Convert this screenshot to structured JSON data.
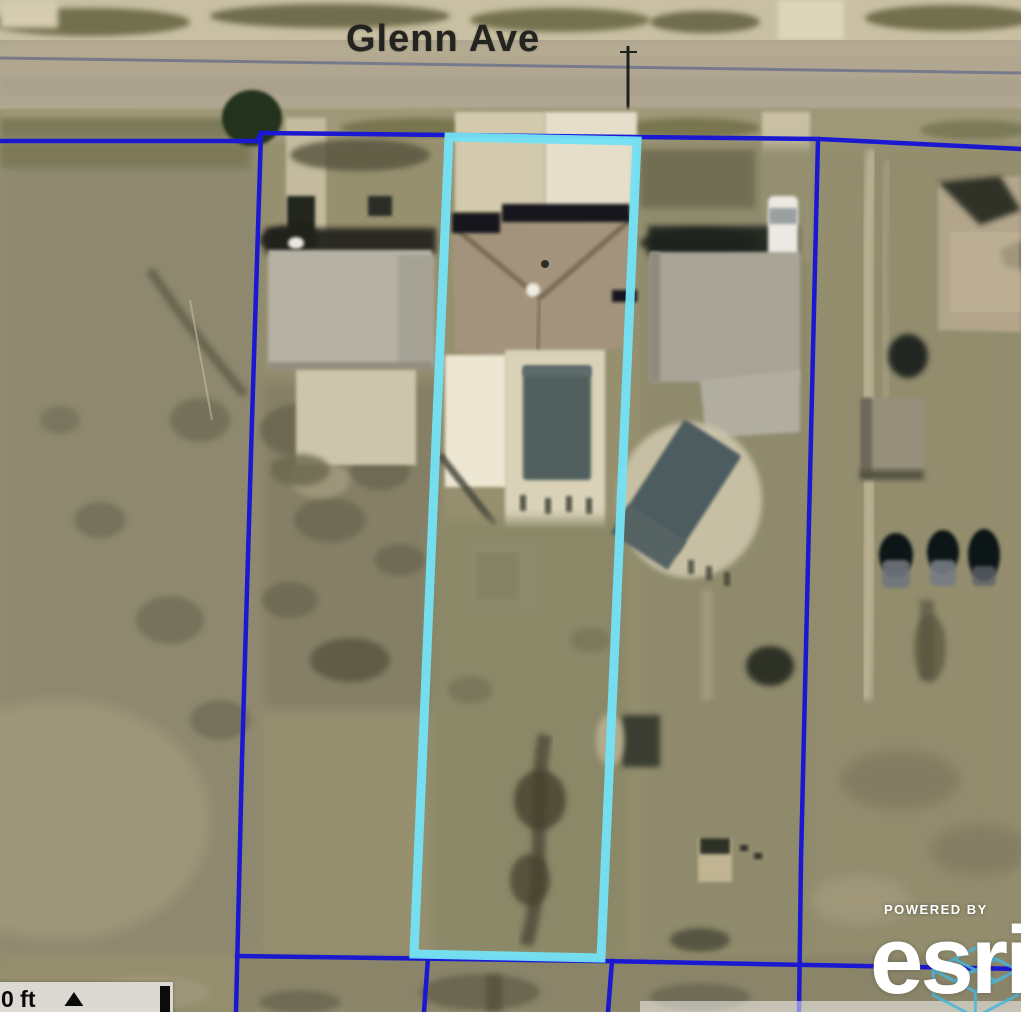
{
  "map": {
    "street_label": "Glenn Ave",
    "scalebar": {
      "label": "0 ft"
    },
    "attribution": {
      "powered_by": "POWERED BY",
      "logo": "esri"
    },
    "icons": {
      "up_triangle": "▲"
    },
    "colors": {
      "parcel_line": "#1b18d2",
      "selected_parcel": "#74e1f4",
      "street_centerline": "#6d7288",
      "street_label": "#23231f",
      "scalebar_bg": "#dcd9d3",
      "scalebar_fg": "#0a0a0a",
      "attribution_fg": "#ffffff",
      "esri_globe": "#49b8dd"
    }
  }
}
